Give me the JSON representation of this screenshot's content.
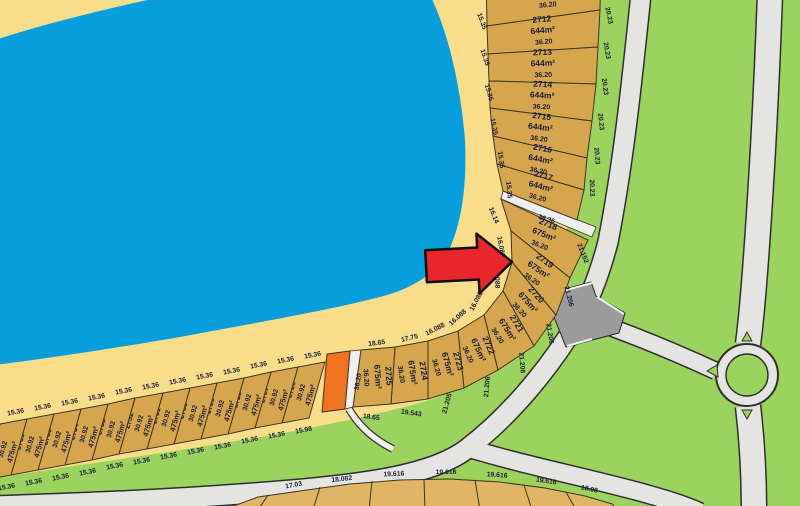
{
  "colors": {
    "grass": "#9cd25e",
    "water": "#089ddd",
    "sand": "#f8dd8b",
    "lot": "#d6a64f",
    "lot_south": "#e0b566",
    "road": "#e4e4e2",
    "junction": "#9b9b9b",
    "path": "#efefef",
    "highlight": "#f0731f",
    "arrow": "#e8262b"
  },
  "lots_644_partial": {
    "area": "644m²",
    "depth": "36.20"
  },
  "lots_644": [
    {
      "number": "2712",
      "area": "644m²",
      "depth": "36.20"
    },
    {
      "number": "2713",
      "area": "644m²",
      "depth": "36.20"
    },
    {
      "number": "2714",
      "area": "644m²",
      "depth": "36.20"
    },
    {
      "number": "2715",
      "area": "644m²",
      "depth": "36.20"
    },
    {
      "number": "2716",
      "area": "644m²",
      "depth": "36.20"
    },
    {
      "number": "2717",
      "area": "644m²",
      "depth": "36.20"
    }
  ],
  "lots_675": [
    {
      "number": "2718",
      "area": "675m²",
      "depth": "36.20"
    },
    {
      "number": "2719",
      "area": "675m²",
      "depth": "36.20"
    },
    {
      "number": "2720",
      "area": "675m²",
      "depth": "36.20"
    },
    {
      "number": "2721",
      "area": "675m²",
      "depth": "36.20"
    },
    {
      "number": "2722",
      "area": "675m²",
      "depth": "36.20"
    },
    {
      "number": "2723",
      "area": "675m²",
      "depth": "36.20"
    },
    {
      "number": "2724",
      "area": "675m²",
      "depth": "36.20"
    },
    {
      "number": "2725",
      "area": "675m²",
      "depth": "36.20"
    }
  ],
  "lots_475": [
    {
      "number": "2726",
      "depth": "30.92",
      "area": "475m²"
    },
    {
      "number": "2727",
      "depth": "30.92",
      "area": "475m²"
    },
    {
      "number": "2728",
      "depth": "30.92",
      "area": "475m²"
    },
    {
      "number": "2729",
      "depth": "30.92",
      "area": "475m²"
    },
    {
      "number": "2730",
      "depth": "30.92",
      "area": "475m²"
    },
    {
      "number": "2731",
      "depth": "30.92",
      "area": "475m²"
    },
    {
      "number": "2732",
      "depth": "30.92",
      "area": "475m²"
    },
    {
      "number": "2733",
      "depth": "30.92",
      "area": "475m²"
    },
    {
      "number": "2734",
      "depth": "30.92",
      "area": "475m²"
    },
    {
      "number": "2735",
      "depth": "30.92",
      "area": "475m²"
    },
    {
      "number": "2736",
      "depth": "30.92",
      "area": "475m²"
    },
    {
      "number": "2737",
      "depth": "30.92",
      "area": "475m²"
    }
  ],
  "dims": {
    "beach_top": [
      "15.35",
      "15.35",
      "15.35",
      "15.35",
      "15.35",
      "15.35"
    ],
    "verge_top": [
      "20.23",
      "20.23",
      "20.23",
      "20.23",
      "20.23",
      "20.23"
    ],
    "walkway_north": "36.36",
    "beach_mid": [
      "16.14",
      "16.088",
      "16.088",
      "16.088",
      "16.088",
      "16.088",
      "17.75",
      "18.65"
    ],
    "verge_mid": [
      "21.152",
      "21.206",
      "21.206",
      "21.206",
      "21.206",
      "21.205",
      "19.543",
      "18.65"
    ],
    "walkway_south": "36.20",
    "beach_bottom": [
      "15.36",
      "15.36",
      "15.36",
      "15.36",
      "15.36",
      "15.36",
      "15.36",
      "15.36",
      "15.36",
      "15.36",
      "15.36",
      "15.36"
    ],
    "verge_bottom": [
      "15.98",
      "15.36",
      "15.36",
      "15.36",
      "15.36",
      "15.36",
      "15.36",
      "15.36",
      "15.36",
      "15.36",
      "15.36",
      "15.36"
    ],
    "road_bottom": [
      "17.03",
      "18.082",
      "19.616",
      "19.616",
      "19.616",
      "19.616",
      "18.08"
    ]
  }
}
